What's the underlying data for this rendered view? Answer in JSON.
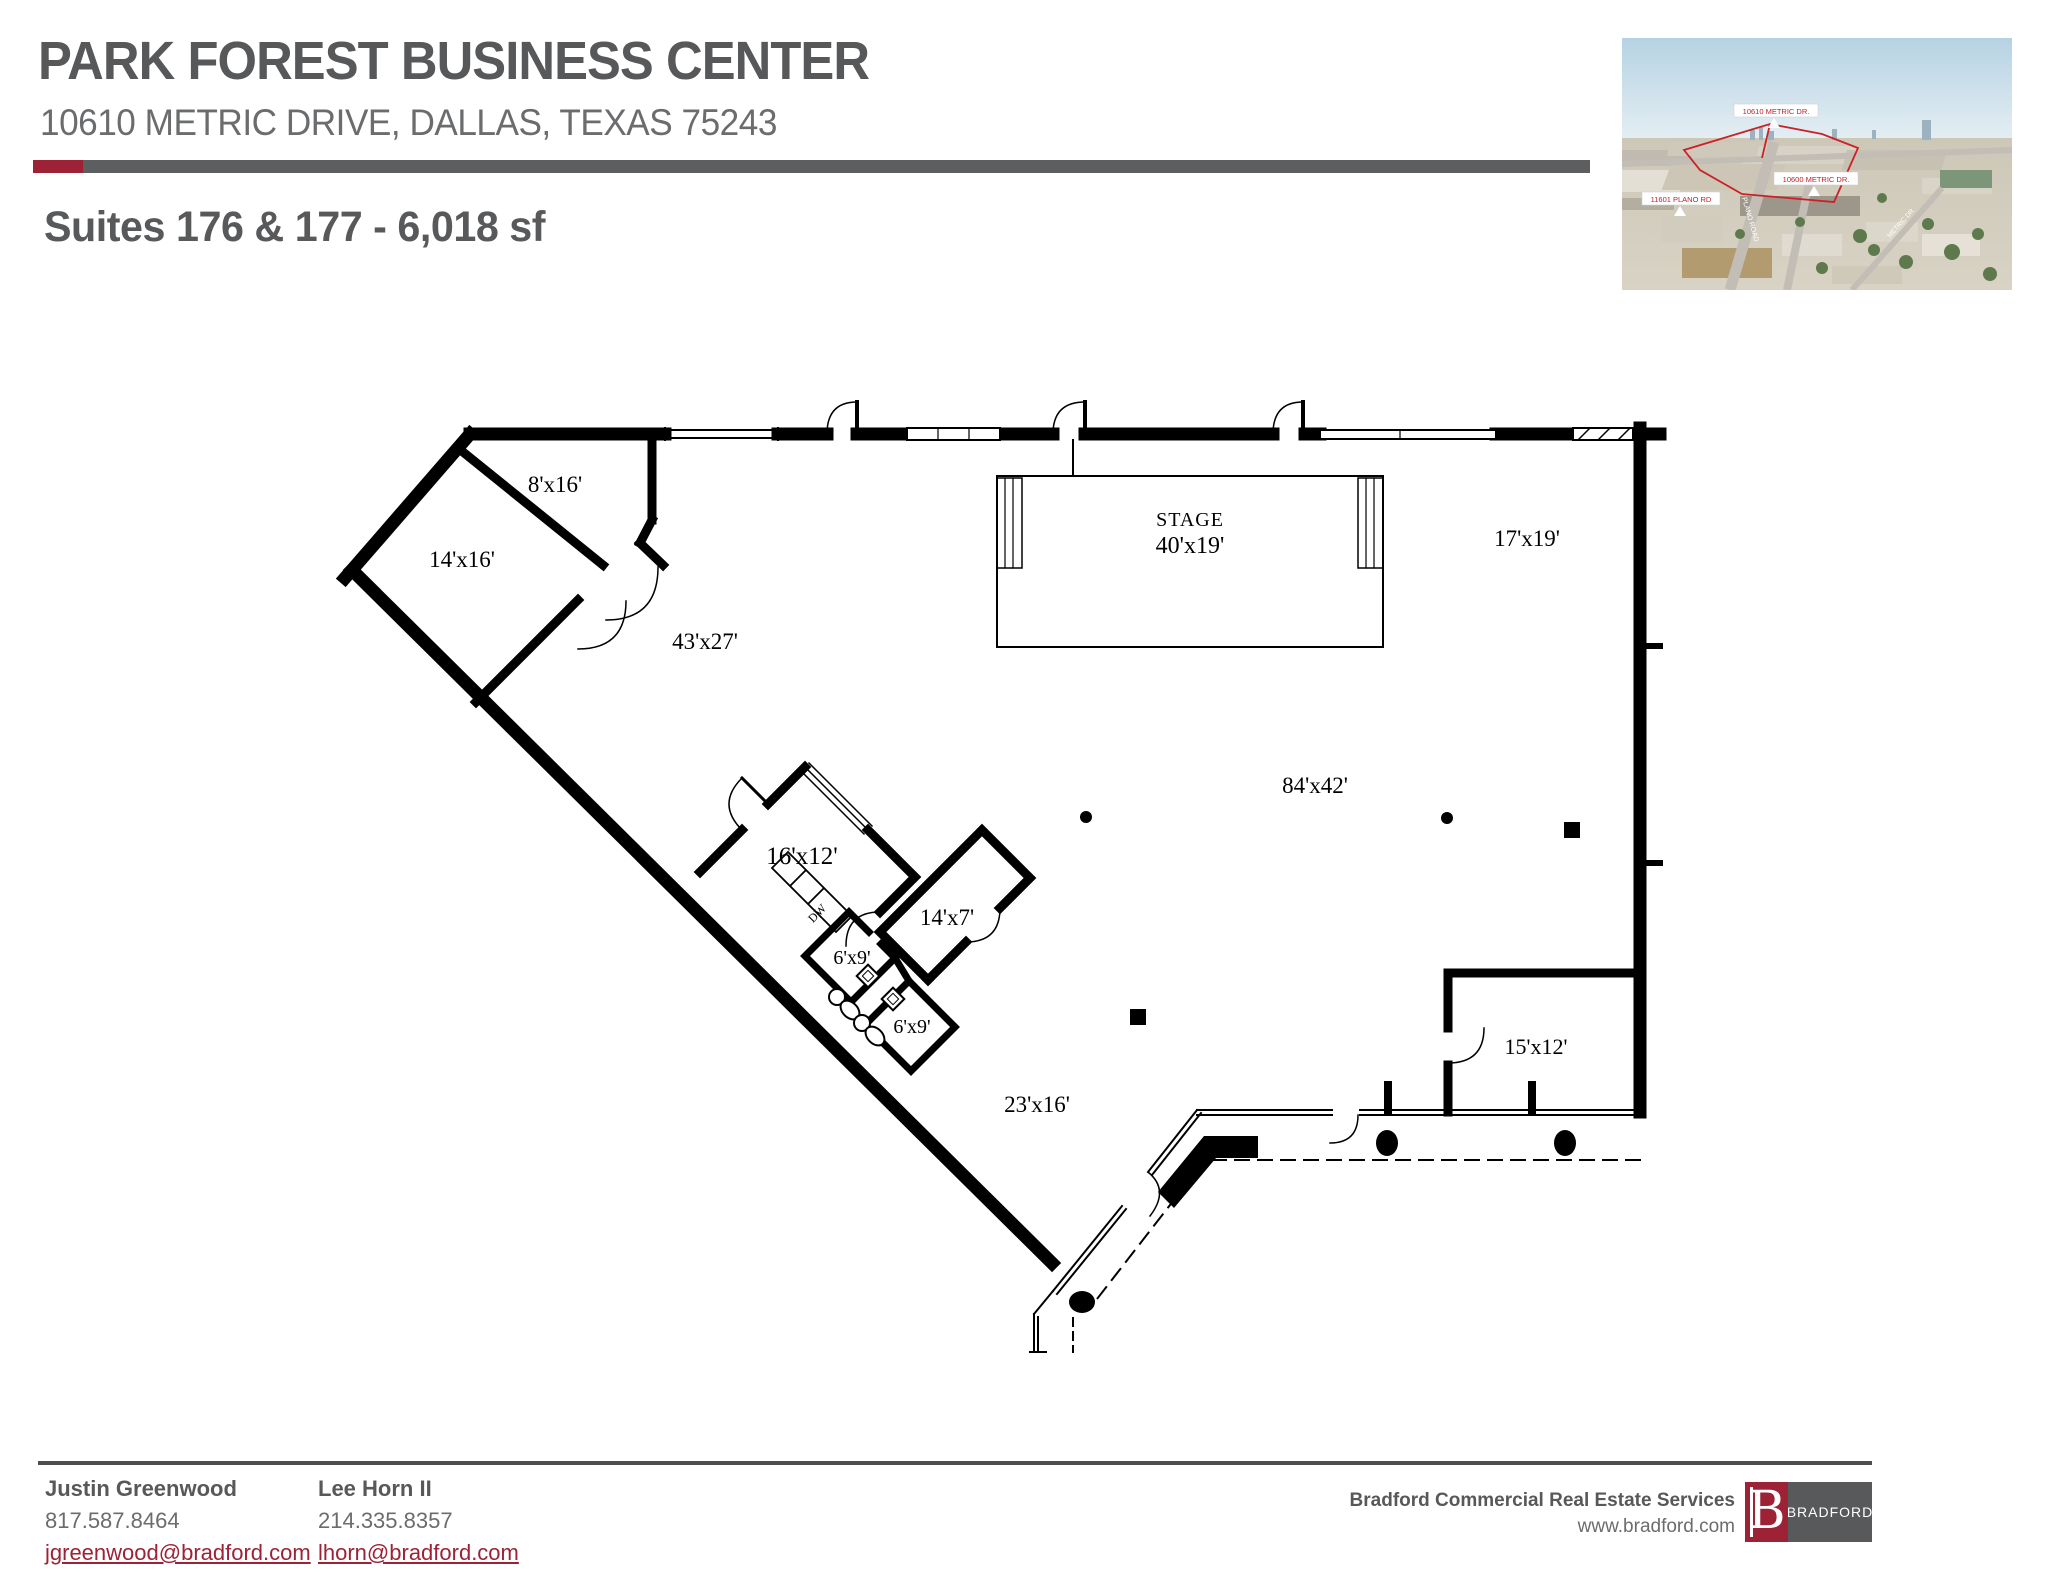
{
  "header": {
    "title": "PARK FOREST BUSINESS CENTER",
    "address": "10610 METRIC DRIVE, DALLAS, TEXAS 75243",
    "subtitle": "Suites 176 & 177 - 6,018 sf"
  },
  "colors": {
    "maroon": "#9d2235",
    "bar_gray": "#5d5e60",
    "text_dark": "#57585a",
    "text_mid": "#6b6c6e",
    "plan_line": "#000000",
    "aerial_outline_red": "#cc2027"
  },
  "floorplan": {
    "labels": {
      "room_8x16": "8'x16'",
      "room_14x16": "14'x16'",
      "room_43x27": "43'x27'",
      "stage_name": "STAGE",
      "stage_size": "40'x19'",
      "room_17x19": "17'x19'",
      "area_84x42": "84'x42'",
      "room_16x12": "16'x12'",
      "room_14x7": "14'x7'",
      "room_6x9_a": "6'x9'",
      "room_6x9_b": "6'x9'",
      "room_23x16": "23'x16'",
      "room_15x12": "15'x12'",
      "dishwasher": "DW"
    }
  },
  "aerial": {
    "tags": {
      "t1": "10610 METRIC DR.",
      "t2": "10600 METRIC DR.",
      "t3": "11601 PLANO RD"
    },
    "roads": {
      "r1": "PLANO ROAD",
      "r2": "METRIC DR"
    }
  },
  "contacts": [
    {
      "name": "Justin Greenwood",
      "phone": "817.587.8464",
      "email": "jgreenwood@bradford.com"
    },
    {
      "name": "Lee Horn II",
      "phone": "214.335.8357",
      "email": "lhorn@bradford.com"
    }
  ],
  "footer": {
    "company": "Bradford Commercial Real Estate Services",
    "website": "www.bradford.com",
    "logo_letter": "B",
    "logo_name": "BRADFORD"
  }
}
